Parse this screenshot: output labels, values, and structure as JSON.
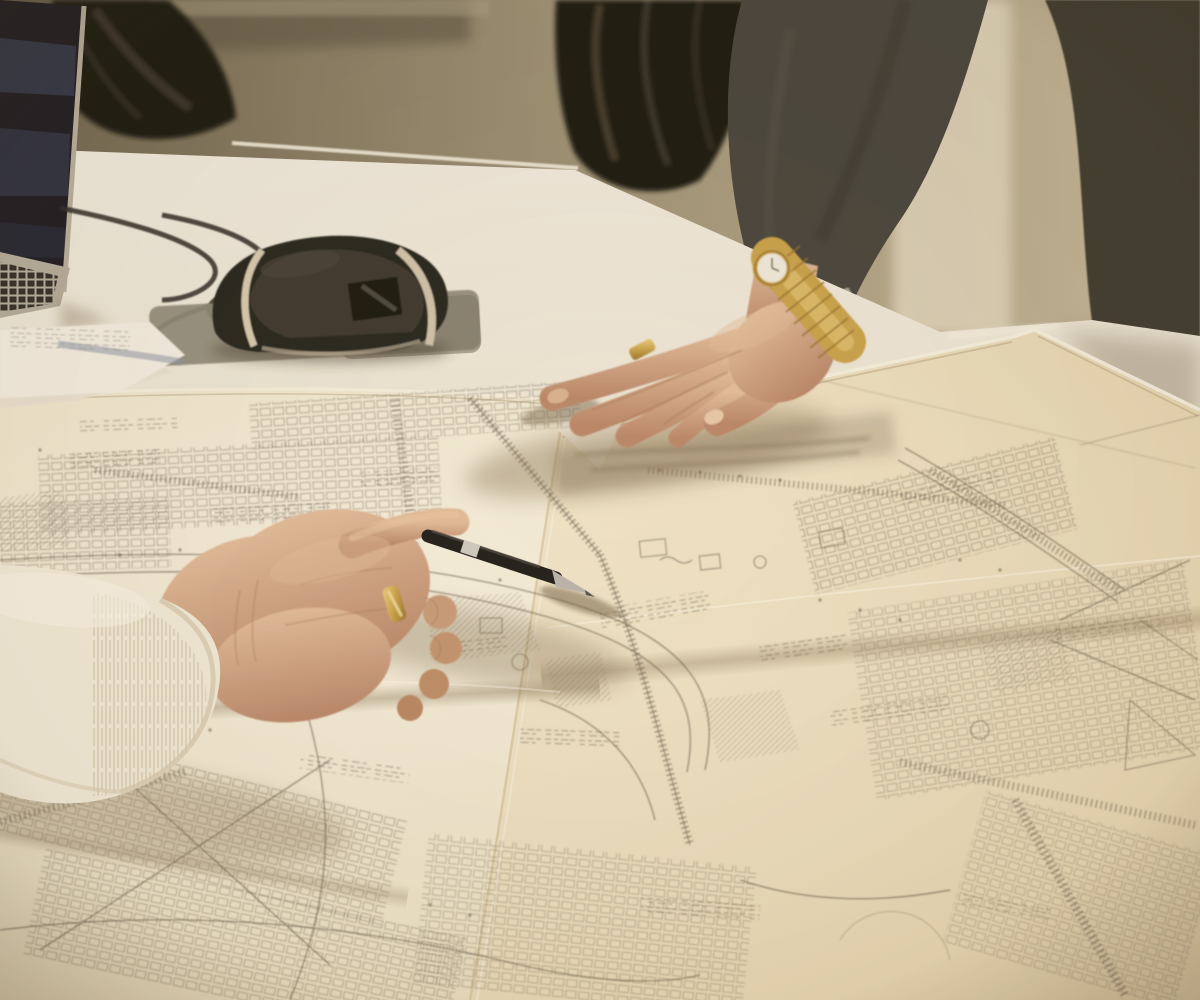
{
  "scene": {
    "description": "Photograph: two people lean over large architectural site plans spread across a white conference table. A left hand in a cream knit sleeve points with a black ballpoint pen; a right hand with a gold wristwatch and gold ring reaches onto the drawings. A laptop, black mouse on a grey pad, cables and note papers sit at the left; black office chairs and an olive wall are behind.",
    "objects": [
      "laptop",
      "office-chair-left",
      "office-chair-right",
      "computer-mouse",
      "mouse-pad",
      "cables",
      "note-papers",
      "blueprint-sheets",
      "ballpoint-pen",
      "gold-watch",
      "gold-ring-left",
      "gold-ring-right",
      "left-hand",
      "right-hand",
      "cream-knit-sleeve",
      "grey-knit-sleeve",
      "standing-person",
      "conference-table",
      "background-wall"
    ],
    "text_visible": "none (plan annotations are illegible at this resolution)"
  },
  "palette": {
    "wall_dark": "#6a614c",
    "wall_mid": "#9a8e74",
    "wall_light": "#c6b99b",
    "pillar": "#ddd3bb",
    "chair": "#16130f",
    "chair_sheen": "#6e6450",
    "sleeve": "#45423c",
    "trousers": "#3a372f",
    "table_light": "#f0ebdf",
    "table_warm": "#e6dcc6",
    "paper_bright": "#f7f1e1",
    "paper_mid": "#efe5cb",
    "paper_warm": "#dcc9a2",
    "paper_overlay": "#e9d7b0",
    "ink": "#5d5243",
    "skin_light": "#e3bd9c",
    "skin_mid": "#c79c7a",
    "skin_dark": "#a87c5c",
    "gold": "#c9a24b",
    "gold_dark": "#96712b",
    "gold_light": "#eed084",
    "watch_face": "#efeadd",
    "pen_black": "#1d1b18",
    "pen_silver": "#cfcbc2",
    "cream": "#f3ecdb",
    "cream_shadow": "#d9cdb2",
    "rib": "#d2c6aa",
    "mouse_black": "#24211c",
    "mouse_gray": "#3a362f",
    "mouse_stripe": "#d7cbb2",
    "pad": "#8f897a",
    "cable": "#2a2722",
    "note_paper": "#f4efe4",
    "folder_blue": "#8d96a8",
    "shadow": "#7a6648",
    "screen": "#1a1820",
    "screen_band": "#3f4a66",
    "laptop_body": "#b3ac9c"
  }
}
